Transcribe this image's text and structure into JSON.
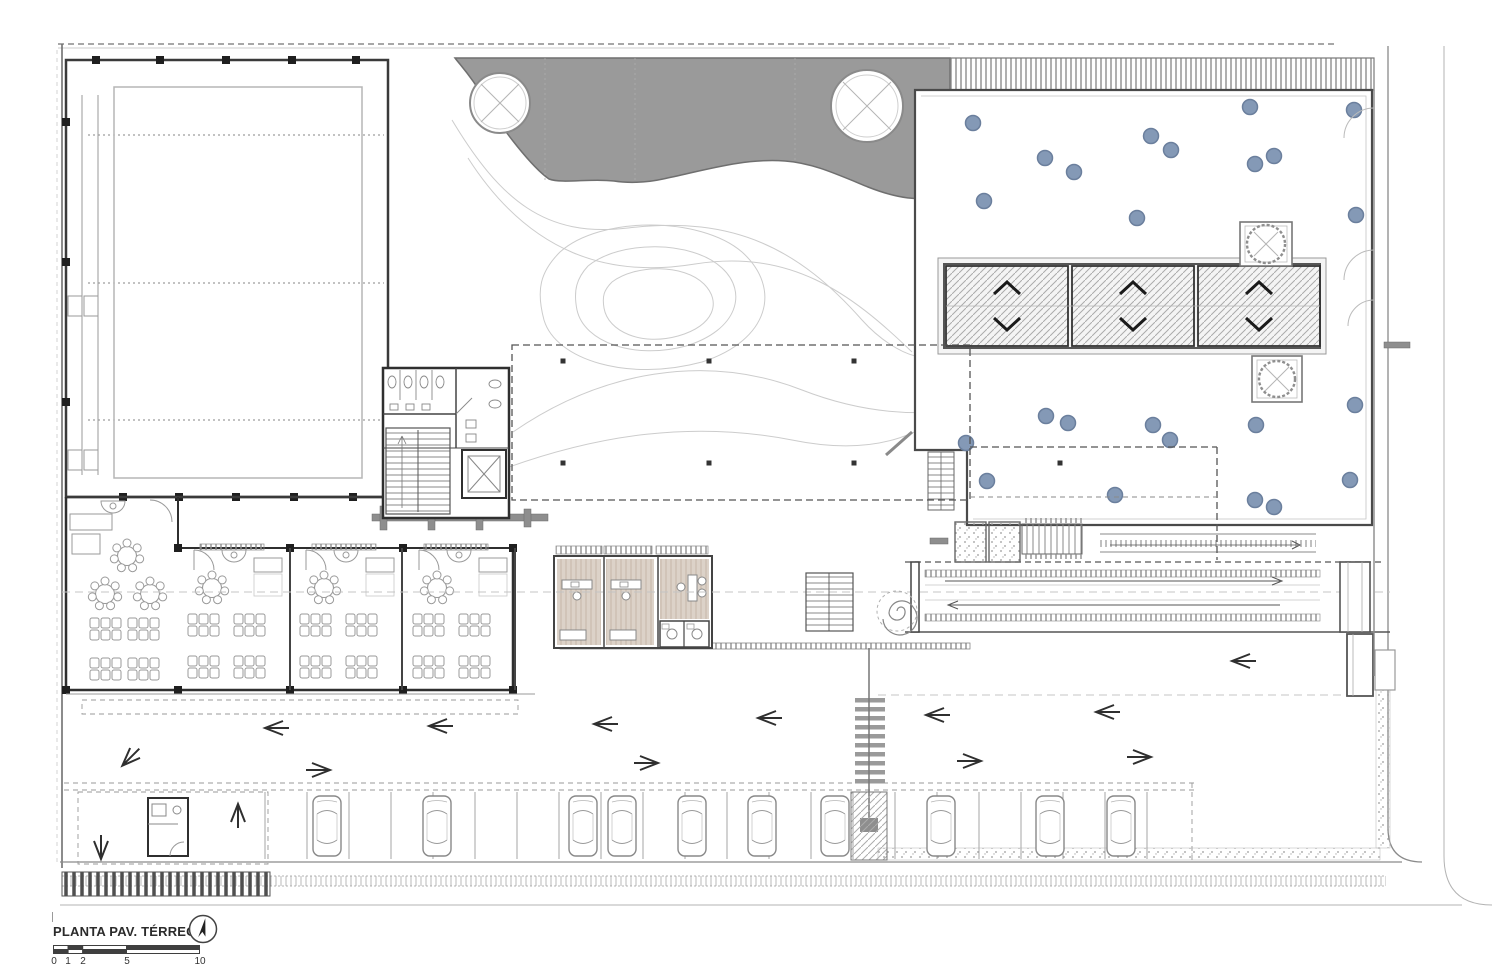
{
  "drawing": {
    "title": "PLANTA PAV. TÉRREO",
    "scale_labels": [
      "0",
      "1",
      "2",
      "5",
      "10"
    ],
    "north_arrow_icon": "north-arrow"
  },
  "section_markers": [
    {
      "letter": "C",
      "edge": "top",
      "x": 683,
      "y": 6
    },
    {
      "letter": "D",
      "edge": "top",
      "x": 1258,
      "y": 6
    },
    {
      "letter": "C",
      "edge": "bottom",
      "x": 683,
      "y": 930
    },
    {
      "letter": "D",
      "edge": "bottom",
      "x": 1258,
      "y": 930
    },
    {
      "letter": "A",
      "edge": "left",
      "x": 10,
      "y": 285
    },
    {
      "letter": "B",
      "edge": "left",
      "x": 10,
      "y": 591
    },
    {
      "letter": "A",
      "edge": "right",
      "x": 1490,
      "y": 285
    },
    {
      "letter": "B",
      "edge": "right",
      "x": 1490,
      "y": 591
    }
  ],
  "colors": {
    "canopy_gray": "#9a9a9a",
    "dot_fill": "#8499b6",
    "dot_stroke": "#6b7f9d",
    "wood_floor": "#dcd2c8",
    "wall_dark": "#333333",
    "line_light": "#b5b5b5"
  },
  "site": {
    "courtyard_dots": [
      [
        973,
        123
      ],
      [
        1250,
        107
      ],
      [
        1354,
        110
      ],
      [
        1151,
        136
      ],
      [
        1171,
        150
      ],
      [
        1045,
        158
      ],
      [
        1274,
        156
      ],
      [
        1255,
        164
      ],
      [
        1074,
        172
      ],
      [
        984,
        201
      ],
      [
        1137,
        218
      ],
      [
        1356,
        215
      ],
      [
        966,
        443
      ],
      [
        1046,
        416
      ],
      [
        1068,
        423
      ],
      [
        1153,
        425
      ],
      [
        1170,
        440
      ],
      [
        1256,
        425
      ],
      [
        1355,
        405
      ],
      [
        987,
        481
      ],
      [
        1115,
        495
      ],
      [
        1350,
        480
      ],
      [
        1255,
        500
      ],
      [
        1274,
        507
      ]
    ],
    "patio_columns": [
      [
        563,
        361
      ],
      [
        709,
        361
      ],
      [
        854,
        361
      ],
      [
        563,
        463
      ],
      [
        709,
        463
      ],
      [
        854,
        463
      ],
      [
        1060,
        463
      ]
    ],
    "street_trees_bottom": [
      [
        365,
        886
      ],
      [
        550,
        884
      ],
      [
        733,
        883
      ],
      [
        918,
        882
      ],
      [
        1102,
        879
      ],
      [
        1286,
        876
      ]
    ],
    "street_trees_right": [
      [
        1421,
        68
      ],
      [
        1419,
        247
      ],
      [
        1421,
        441
      ],
      [
        1424,
        634
      ],
      [
        1424,
        806
      ]
    ],
    "planter_trees": [
      [
        1266,
        244
      ],
      [
        1277,
        379
      ]
    ],
    "plaza_tree": [
      1261,
      745
    ],
    "classroom_module_xs": [
      178,
      290,
      403
    ],
    "parked_car_xs": [
      327,
      437,
      583,
      622,
      692,
      762,
      835,
      941,
      1050,
      1121
    ],
    "parking_stalls": {
      "from": 265,
      "to": 1188,
      "step": 42,
      "top": 792,
      "bottom": 859
    },
    "driveway_arrows": [
      {
        "x": 273,
        "y": 728,
        "dir": "left"
      },
      {
        "x": 437,
        "y": 726,
        "dir": "left"
      },
      {
        "x": 602,
        "y": 724,
        "dir": "left"
      },
      {
        "x": 766,
        "y": 718,
        "dir": "left"
      },
      {
        "x": 934,
        "y": 715,
        "dir": "left"
      },
      {
        "x": 1104,
        "y": 712,
        "dir": "left"
      },
      {
        "x": 1240,
        "y": 661,
        "dir": "left"
      },
      {
        "x": 322,
        "y": 770,
        "dir": "right"
      },
      {
        "x": 650,
        "y": 763,
        "dir": "right"
      },
      {
        "x": 973,
        "y": 761,
        "dir": "right"
      },
      {
        "x": 1143,
        "y": 757,
        "dir": "right"
      },
      {
        "x": 238,
        "y": 812,
        "dir": "up"
      },
      {
        "x": 128,
        "y": 760,
        "dir": "down-left"
      },
      {
        "x": 101,
        "y": 851,
        "dir": "down"
      }
    ],
    "plaza_cars": [
      {
        "x": 253,
        "y": 732,
        "rot": 0
      },
      {
        "x": 592,
        "y": 729,
        "rot": 0
      },
      {
        "x": 923,
        "y": 722,
        "rot": 0
      },
      {
        "x": 1010,
        "y": 673,
        "rot": 2
      },
      {
        "x": 1092,
        "y": 670,
        "rot": -2
      },
      {
        "x": 1252,
        "y": 695,
        "rot": -24
      },
      {
        "x": 1318,
        "y": 757,
        "rot": 62
      },
      {
        "x": 1249,
        "y": 796,
        "rot": -18
      }
    ]
  }
}
